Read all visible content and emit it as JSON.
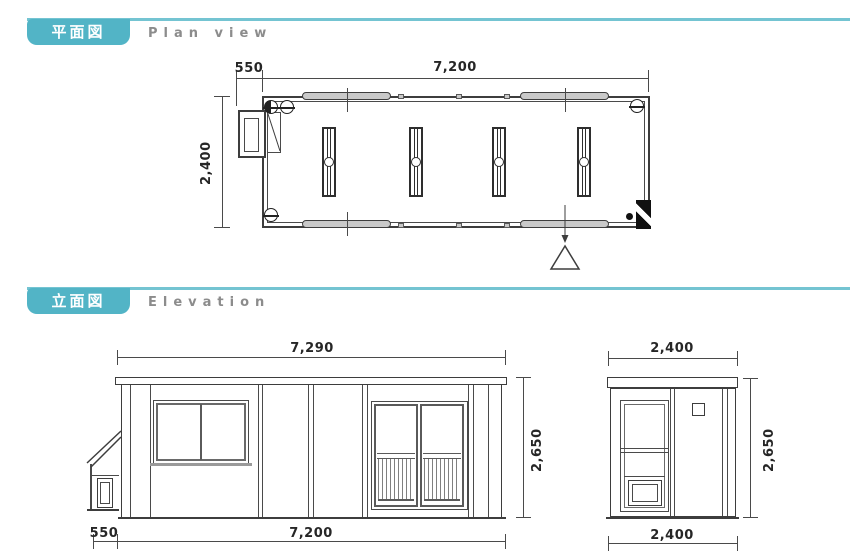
{
  "colors": {
    "accent": "#52b4c6",
    "accent_light": "#74c4d2",
    "heading_gray": "#8c8c8c",
    "line": "#3d3d3d"
  },
  "sections": {
    "plan": {
      "badge": "平面図",
      "subtitle": "Plan view"
    },
    "elevation": {
      "badge": "立面図",
      "subtitle": "Elevation"
    }
  },
  "plan": {
    "dim_porch_width": "550",
    "dim_body_width": "7,200",
    "dim_depth": "2,400"
  },
  "front_elevation": {
    "dim_total_width": "7,290",
    "dim_height": "2,650",
    "dim_porch": "550",
    "dim_body": "7,200"
  },
  "side_elevation": {
    "dim_width_top": "2,400",
    "dim_height": "2,650",
    "dim_width_bottom": "2,400"
  }
}
